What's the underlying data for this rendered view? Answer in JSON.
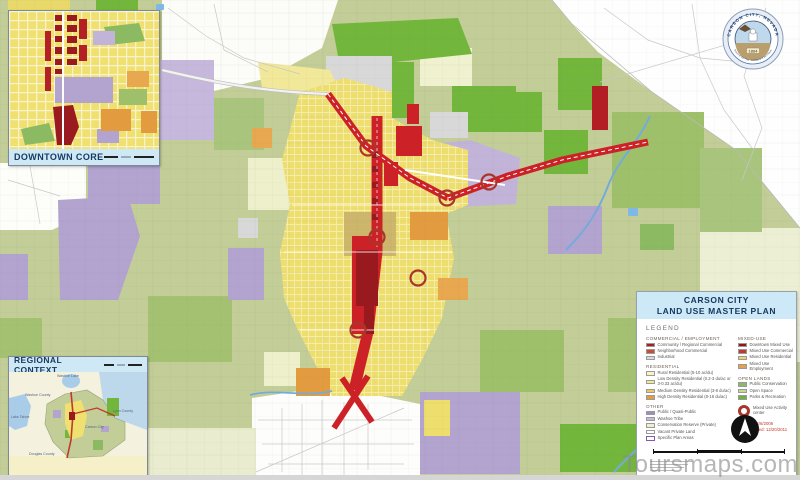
{
  "watermark": "Toursmaps.com",
  "legend": {
    "title_line1": "CARSON CITY",
    "title_line2": "LAND USE MASTER PLAN",
    "heading": "LEGEND",
    "columns": {
      "left": [
        {
          "title": "COMMERCIAL / EMPLOYMENT",
          "items": [
            {
              "label": "Community / Regional Commercial",
              "color": "#a81e22"
            },
            {
              "label": "Neighborhood Commercial",
              "color": "#cd4b35"
            },
            {
              "label": "Industrial",
              "color": "#d9d9d9"
            }
          ]
        },
        {
          "title": "RESIDENTIAL",
          "items": [
            {
              "label": "Rural Residential (5-10 ac/du)",
              "color": "#f7f3c6"
            },
            {
              "label": "Low Density Residential (0.2-3 du/ac or 3-0.33 ac/du)",
              "color": "#f3ea8a"
            },
            {
              "label": "Medium Density Residential (3-8 du/ac)",
              "color": "#f0c75e"
            },
            {
              "label": "High Density Residential (8-16 du/ac)",
              "color": "#e39c44"
            }
          ]
        },
        {
          "title": "OTHER",
          "items": [
            {
              "label": "Public / Quasi-Public",
              "color": "#9c8cc3"
            },
            {
              "label": "Washoe Tribe",
              "color": "#c7b9dc"
            },
            {
              "label": "Conservation Reserve (Private)",
              "color": "#eef0cd"
            },
            {
              "label": "Vacant Private Land",
              "color": "#ffffff"
            },
            {
              "label": "Specific Plan Areas",
              "color": "#ffffff",
              "border": "#7e5ea8"
            }
          ]
        }
      ],
      "right": [
        {
          "title": "MIXED-USE",
          "items": [
            {
              "label": "Downtown Mixed Use",
              "color": "#8e191d"
            },
            {
              "label": "Mixed Use Commercial",
              "color": "#c23a2e"
            },
            {
              "label": "Mixed Use Residential",
              "color": "#f2d465"
            },
            {
              "label": "Mixed Use Employment",
              "color": "#e5a04e"
            }
          ]
        },
        {
          "title": "OPEN LANDS",
          "items": [
            {
              "label": "Public Conservation",
              "color": "#8cba62"
            },
            {
              "label": "Open Space",
              "color": "#c6d994"
            },
            {
              "label": "Parks & Recreation",
              "color": "#6fb13b"
            }
          ]
        }
      ]
    },
    "activity_center_label": "Mixed Use Activity center",
    "adopted": "Adopted: 4/6/2006",
    "last_updated": "Last Updated: 12/20/2011"
  },
  "insets": {
    "downtown": {
      "label": "DOWNTOWN CORE"
    },
    "regional": {
      "label": "REGIONAL CONTEXT",
      "labels": [
        "Washoe Lake",
        "Washoe County",
        "Lake Tahoe",
        "Carson City",
        "Lyon County",
        "Douglas County"
      ]
    }
  },
  "seal": {
    "ring_text": "CARSON CITY, NEVADA",
    "year": "1864",
    "motto": "Proud of the Past - Confident of the Future"
  }
}
